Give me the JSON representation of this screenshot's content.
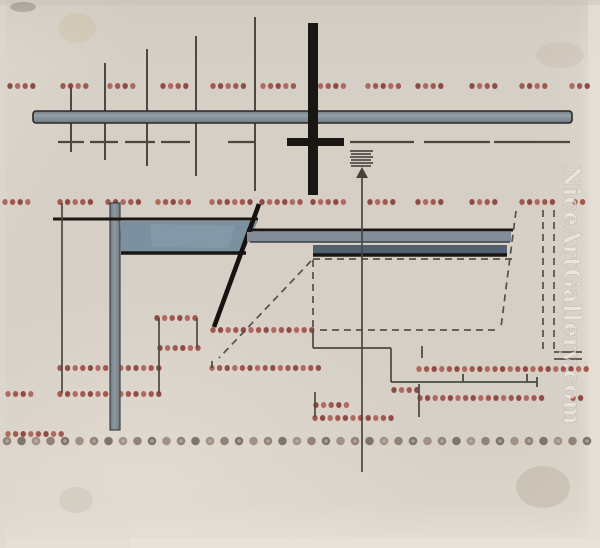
{
  "title": "Abstract constructivist composition — scanned artwork with gallery watermark",
  "watermark": {
    "text": "NiceArtGallery.com",
    "color": "rgba(240,236,229,0.82)",
    "shadow_color": "rgba(120,112,100,0.25)",
    "x": 564,
    "y": 166,
    "rotation": 90,
    "font_size": 23,
    "letter_spacing": 0.5
  },
  "palette": {
    "paper": "#d6cfc5",
    "black": "#1a1613",
    "thin_line": "#4f483f",
    "dash_line": "#565047",
    "red_dot_a": "#9d4d44",
    "red_dot_b": "#8a3f38",
    "red_dot_c": "#ad6156",
    "big_dot_a": "#8b7a6d",
    "big_dot_b": "#776a5e",
    "big_dot_c": "#9b8b7d",
    "bar_fill_light": "#97a1a7",
    "bar_fill_dark": "#6f7a82",
    "vbar_light": "#8f9aa0",
    "vbar_dark": "#6c7880",
    "trapezoid_fill": "#7c91a0",
    "trapezoid_light": "#8fa3b0",
    "bar_a_fill": "#828d98",
    "bar_b_fill": "#526171",
    "bar_edge": "#2b2925"
  },
  "artwork": {
    "paper_patches": [
      {
        "x": 588,
        "y": 0,
        "w": 12,
        "h": 548,
        "fill": "#e4dfd7",
        "opacity": 0.75
      },
      {
        "x": 0,
        "y": 538,
        "w": 600,
        "h": 10,
        "fill": "#e8e3db",
        "opacity": 0.7
      },
      {
        "x": 0,
        "y": 455,
        "w": 130,
        "h": 93,
        "fill": "#e0dbd2",
        "opacity": 0.45
      },
      {
        "x": 0,
        "y": 0,
        "w": 6,
        "h": 548,
        "fill": "#ded8cf",
        "opacity": 0.5
      },
      {
        "x": 0,
        "y": 0,
        "w": 600,
        "h": 5,
        "fill": "#c9c2b8",
        "opacity": 0.45
      }
    ],
    "smudges": [
      {
        "cx": 77,
        "cy": 28,
        "rx": 19,
        "ry": 15,
        "fill": "#c9b98f",
        "opacity": 0.26
      },
      {
        "cx": 560,
        "cy": 55,
        "rx": 24,
        "ry": 13,
        "fill": "#b8ab9c",
        "opacity": 0.2
      },
      {
        "cx": 76,
        "cy": 500,
        "rx": 17,
        "ry": 13,
        "fill": "#b3a693",
        "opacity": 0.22
      },
      {
        "cx": 543,
        "cy": 487,
        "rx": 27,
        "ry": 21,
        "fill": "#a89a88",
        "opacity": 0.28
      },
      {
        "cx": 23,
        "cy": 7,
        "rx": 13,
        "ry": 5,
        "fill": "#5a544c",
        "opacity": 0.3
      }
    ],
    "red_dot_rows": [
      {
        "y": 86,
        "groups": [
          [
            10,
            4
          ],
          [
            63,
            4
          ],
          [
            110,
            4
          ],
          [
            163,
            4
          ],
          [
            213,
            5
          ],
          [
            263,
            5
          ],
          [
            313,
            5
          ],
          [
            368,
            5
          ],
          [
            418,
            4
          ],
          [
            472,
            4
          ],
          [
            522,
            4
          ],
          [
            572,
            3
          ]
        ]
      },
      {
        "y": 202,
        "groups": [
          [
            5,
            4
          ],
          [
            60,
            5
          ],
          [
            108,
            5
          ],
          [
            158,
            5
          ],
          [
            212,
            6
          ],
          [
            262,
            6
          ],
          [
            313,
            5
          ],
          [
            370,
            4
          ],
          [
            418,
            4
          ],
          [
            472,
            4
          ],
          [
            522,
            5
          ],
          [
            575,
            2
          ]
        ]
      },
      {
        "y": 318,
        "groups": [
          [
            157,
            6
          ]
        ]
      },
      {
        "y": 330,
        "groups": [
          [
            213,
            14
          ]
        ]
      },
      {
        "y": 348,
        "groups": [
          [
            160,
            6
          ]
        ]
      },
      {
        "y": 368,
        "groups": [
          [
            60,
            14
          ],
          [
            212,
            15
          ]
        ]
      },
      {
        "y": 369,
        "groups": [
          [
            419,
            23
          ]
        ]
      },
      {
        "y": 390,
        "groups": [
          [
            394,
            4
          ]
        ]
      },
      {
        "y": 394,
        "groups": [
          [
            8,
            4
          ],
          [
            60,
            14
          ]
        ]
      },
      {
        "y": 398,
        "groups": [
          [
            420,
            17
          ],
          [
            573,
            2
          ]
        ]
      },
      {
        "y": 405,
        "groups": [
          [
            316,
            5
          ]
        ]
      },
      {
        "y": 418,
        "groups": [
          [
            315,
            11
          ]
        ]
      },
      {
        "y": 434,
        "groups": [
          [
            8,
            8
          ]
        ]
      }
    ],
    "dot_spacing": 7.6,
    "dot_r": 2.7,
    "big_dot_row": {
      "y": 441,
      "x_start": 7,
      "count": 41,
      "spacing": 14.5,
      "r": 4.3
    },
    "tall_verticals": [
      [
        71,
        85,
        152
      ],
      [
        105,
        63,
        160
      ],
      [
        147,
        49,
        166
      ],
      [
        196,
        36,
        176
      ],
      [
        255,
        17,
        191
      ]
    ],
    "thin_lines": [
      [
        62,
        203,
        62,
        393
      ],
      [
        159,
        318,
        159,
        393
      ],
      [
        197,
        318,
        197,
        348
      ],
      [
        212,
        361,
        212,
        368
      ],
      [
        313,
        330,
        313,
        348
      ],
      [
        313,
        348,
        391,
        348
      ],
      [
        391,
        348,
        391,
        382
      ],
      [
        422,
        346,
        422,
        358
      ],
      [
        419,
        384,
        419,
        417
      ],
      [
        315,
        392,
        315,
        417
      ]
    ],
    "dash_row": {
      "y": 142,
      "segments": [
        [
          58,
          26
        ],
        [
          90,
          28
        ],
        [
          125,
          30
        ],
        [
          161,
          29
        ],
        [
          228,
          27
        ],
        [
          350,
          64
        ],
        [
          424,
          66
        ],
        [
          494,
          76
        ]
      ]
    },
    "top_bar": {
      "x": 33,
      "y": 111,
      "w": 539,
      "h": 12
    },
    "cross": {
      "vx": 308,
      "vy": 23,
      "vw": 10,
      "vh": 172,
      "hx": 287,
      "hy": 138,
      "hw": 57,
      "hh": 8
    },
    "hatch": {
      "x": 350,
      "y": 151,
      "w": 23,
      "count": 6,
      "step": 3
    },
    "arrow": {
      "head": "356,178 368,178 362,167",
      "line": [
        362,
        176,
        362,
        472
      ]
    },
    "v_bar": {
      "x": 110,
      "y": 203,
      "w": 10,
      "h": 227
    },
    "black_h_line": [
      53,
      219,
      258,
      219
    ],
    "trapezoid": {
      "points": "120,221 258,221 243,253 121,253",
      "bottom_edge": [
        121,
        253,
        246,
        253
      ]
    },
    "diagonal": [
      259,
      204,
      214,
      327
    ],
    "bar_a": {
      "top_edge": [
        247,
        230,
        513,
        230
      ],
      "body": {
        "x": 247,
        "y": 232,
        "w": 264,
        "h": 10
      },
      "bottom_edge": [
        250,
        242,
        510,
        242
      ]
    },
    "bar_b": {
      "body": {
        "x": 313,
        "y": 245,
        "w": 194,
        "h": 9
      },
      "bottom_edge": [
        313,
        255,
        507,
        255
      ]
    },
    "dashed_lines": [
      [
        313,
        259,
        512,
        259
      ],
      [
        313,
        260,
        313,
        330
      ],
      [
        320,
        330,
        500,
        330
      ],
      [
        516,
        211,
        501,
        327
      ],
      [
        311,
        261,
        219,
        358
      ],
      [
        543,
        210,
        543,
        351
      ],
      [
        554,
        210,
        554,
        351
      ]
    ],
    "bracket_lines": [
      [
        554,
        352,
        582,
        352
      ],
      [
        554,
        359,
        582,
        359
      ]
    ],
    "dimension_line": {
      "main": [
        391,
        382,
        537,
        382
      ],
      "ticks": [
        [
          463,
          374,
          463,
          382
        ],
        [
          527,
          374,
          527,
          382
        ],
        [
          537,
          377,
          537,
          387
        ]
      ]
    }
  }
}
